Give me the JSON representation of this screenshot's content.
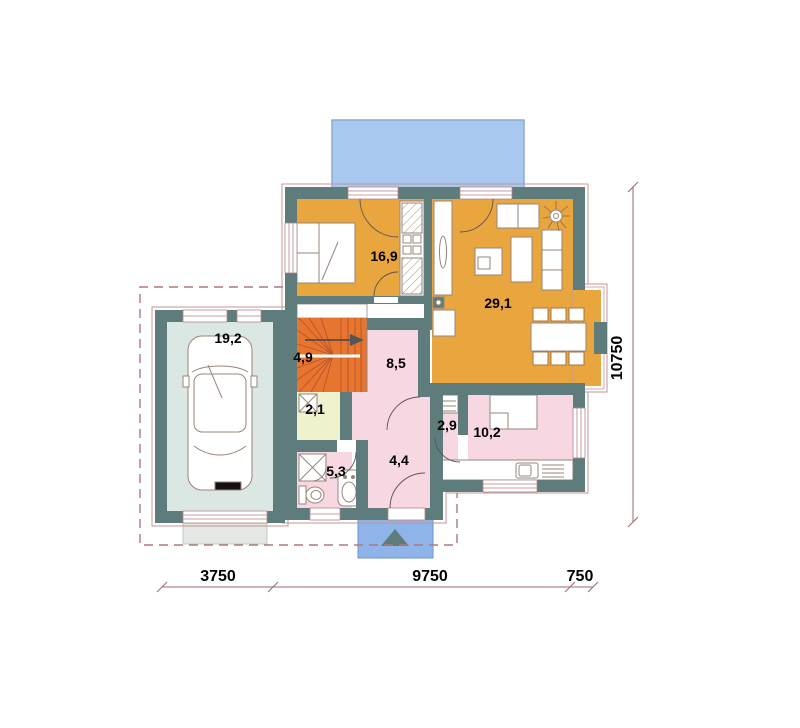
{
  "plan": {
    "type": "floor-plan",
    "rooms": {
      "garage": {
        "area": "19,2"
      },
      "bedroom": {
        "area": "16,9"
      },
      "living": {
        "area": "29,1"
      },
      "stairs": {
        "area": "4,9"
      },
      "hall": {
        "area": "8,5"
      },
      "closet": {
        "area": "2,1"
      },
      "wc": {
        "area": "2,9"
      },
      "utility": {
        "area": "10,2"
      },
      "bath": {
        "area": "5,3"
      },
      "entry": {
        "area": "4,4"
      }
    },
    "dimensions": {
      "bottom_left": "3750",
      "bottom_middle": "9750",
      "bottom_right": "750",
      "right_side": "10750"
    },
    "colors": {
      "wall": "#5F7C7C",
      "room_orange": "#E9A53E",
      "stairs_orange": "#E8752F",
      "room_pink": "#F7D7E1",
      "closet_cream": "#F0F2CE",
      "garage_grey": "#DBE7E3",
      "driveway_grey": "#E4E7E4",
      "terrace_blue": "#A9C8F0",
      "porch_blue": "#8FB4EA",
      "dim_line": "#9B6B6B",
      "dash_line": "#B07878",
      "furniture_outline": "#9A8478",
      "window_frame": "#B58585"
    }
  }
}
